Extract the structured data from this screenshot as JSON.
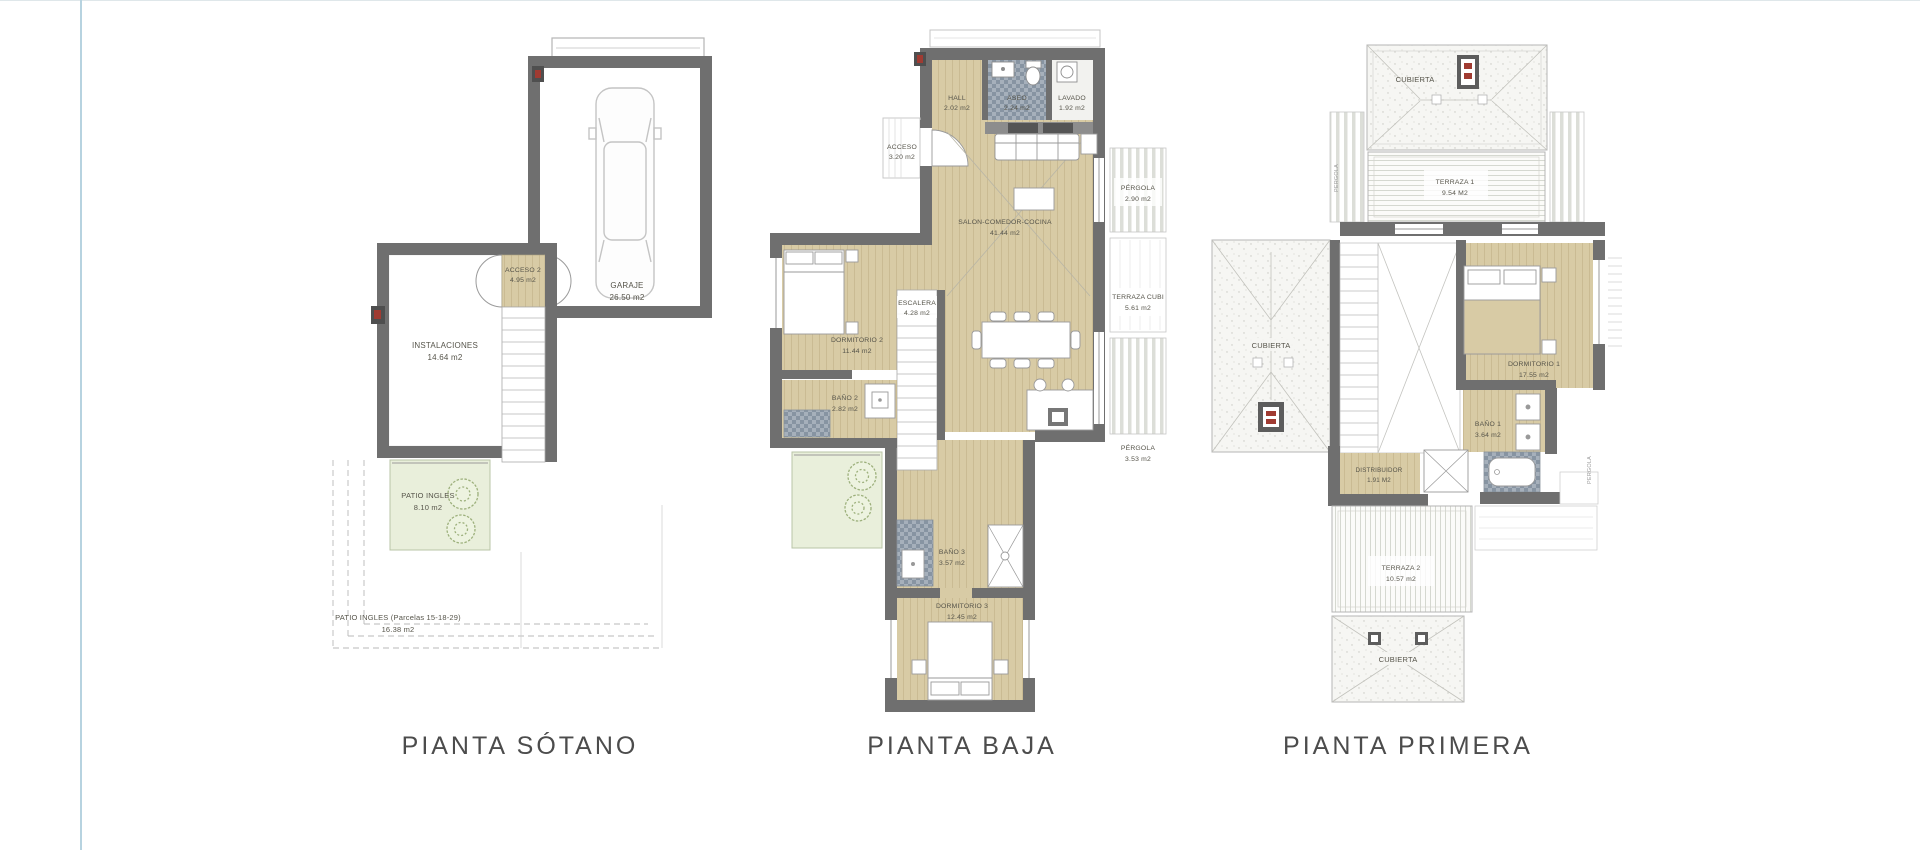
{
  "page": {
    "background": "#ffffff",
    "left_rule_color": "#b7d3e0",
    "top_rule_color": "#dfe7ea"
  },
  "colors": {
    "wall": "#6f6f6f",
    "floor_tan": "#d8cba5",
    "patio_green": "#e9efdb",
    "tile": "#8794a2",
    "label_text": "#56544a",
    "title_text": "#4c4c4c",
    "marker_red": "#a03b32"
  },
  "plans": [
    {
      "title": "PIANTA SÓTANO",
      "rooms": [
        {
          "label": "INSTALACIONES",
          "area": "14.64 m2"
        },
        {
          "label": "ACCESO 2",
          "area": "4.95 m2"
        },
        {
          "label": "GARAJE",
          "area": "26.50 m2"
        },
        {
          "label": "PATIO INGLES",
          "area": "8.10 m2"
        },
        {
          "label": "PATIO INGLES (Parcelas 15-18-29)",
          "area": "16.38 m2"
        }
      ]
    },
    {
      "title": "PIANTA BAJA",
      "rooms": [
        {
          "label": "HALL",
          "area": "2.02 m2"
        },
        {
          "label": "ASEO",
          "area": "2.24 m2"
        },
        {
          "label": "LAVADO",
          "area": "1.92 m2"
        },
        {
          "label": "ACCESO",
          "area": "3.20 m2"
        },
        {
          "label": "SALON-COMEDOR-COCINA",
          "area": "41.44 m2"
        },
        {
          "label": "PÉRGOLA",
          "area": "2.90 m2"
        },
        {
          "label": "TERRAZA CUBI",
          "area": "5.61 m2"
        },
        {
          "label": "DORMITORIO 2",
          "area": "11.44 m2"
        },
        {
          "label": "ESCALERA",
          "area": "4.28 m2"
        },
        {
          "label": "BAÑO 2",
          "area": "2.82 m2"
        },
        {
          "label": "PÉRGOLA",
          "area": "3.53 m2"
        },
        {
          "label": "BAÑO 3",
          "area": "3.57 m2"
        },
        {
          "label": "DORMITORIO 3",
          "area": "12.45 m2"
        }
      ]
    },
    {
      "title": "PIANTA PRIMERA",
      "rooms": [
        {
          "label": "CUBIERTA",
          "area": ""
        },
        {
          "label": "TERRAZA 1",
          "area": "9.54 M2"
        },
        {
          "label": "CUBIERTA",
          "area": ""
        },
        {
          "label": "DORMITORIO 1",
          "area": "17.55 m2"
        },
        {
          "label": "BAÑO 1",
          "area": "3.64 m2"
        },
        {
          "label": "DISTRIBUIDOR",
          "area": "1.91 M2"
        },
        {
          "label": "TERRAZA 2",
          "area": "10.57 m2"
        },
        {
          "label": "CUBIERTA",
          "area": ""
        }
      ],
      "side_labels": [
        "PERGOLA",
        "PERGOLA"
      ]
    }
  ]
}
